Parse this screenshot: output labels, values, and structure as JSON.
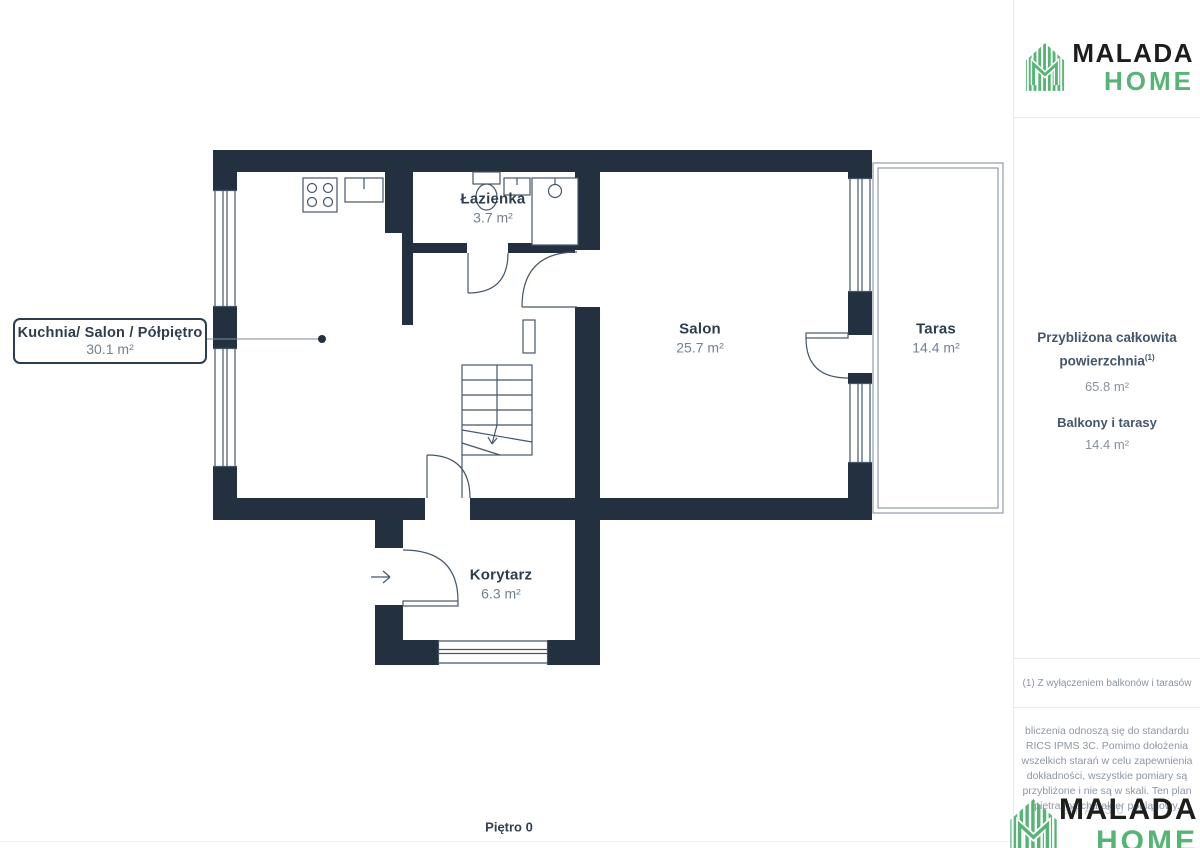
{
  "colors": {
    "wall_navy": "#23303f",
    "accent_green": "#57b476",
    "logo_black": "#1d1d1b",
    "line": "#46566a"
  },
  "logo": {
    "brand": "MALADA",
    "sub": "HOME"
  },
  "plan": {
    "floor_label": "Piętro 0",
    "rooms": [
      {
        "id": "kuchnia",
        "name": "Kuchnia/ Salon / Półpiętro",
        "area": "30.1 m²"
      },
      {
        "id": "lazienka",
        "name": "Łazienka",
        "area": "3.7 m²"
      },
      {
        "id": "salon",
        "name": "Salon",
        "area": "25.7 m²"
      },
      {
        "id": "taras",
        "name": "Taras",
        "area": "14.4 m²"
      },
      {
        "id": "korytarz",
        "name": "Korytarz",
        "area": "6.3 m²"
      }
    ]
  },
  "sidebar": {
    "summary": {
      "title": "Przybliżona całkowita powierzchnia",
      "title_sup": "(1)",
      "total_value": "65.8 m²",
      "balconies_label": "Balkony i tarasy",
      "balconies_value": "14.4 m²"
    },
    "footnote": "(1) Z wyłączeniem balkonów i tarasów",
    "disclaimer_lines": [
      "bliczenia odnoszą się do standardu",
      "RICS IPMS 3C. Pomimo dołożenia",
      "wszelkich starań w celu zapewnienia",
      "dokładności, wszystkie pomiary są",
      "przybliżone i nie są w skali. Ten plan",
      "piętra ma charakter poglądowy."
    ],
    "watermark": "GIRA 43.0"
  }
}
